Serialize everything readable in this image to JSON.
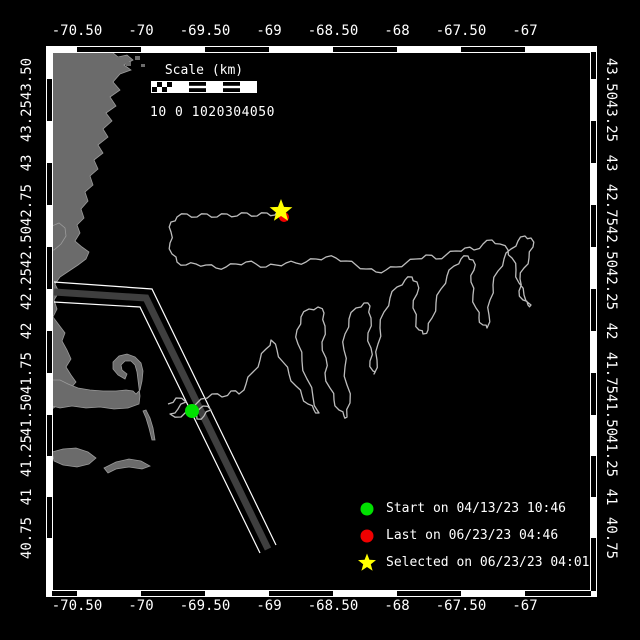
{
  "figure": {
    "background": "#000000",
    "text_color": "#ffffff",
    "frame_color": "#ffffff"
  },
  "axes": {
    "top": {
      "labels": [
        "-70.50",
        "-70",
        "-69.50",
        "-69",
        "-68.50",
        "-68",
        "-67.50",
        "-67"
      ],
      "positions_px": [
        77,
        141,
        205,
        269,
        333,
        397,
        461,
        525
      ],
      "center_y": 31
    },
    "bottom": {
      "labels": [
        "-70.50",
        "-70",
        "-69.50",
        "-69",
        "-68.50",
        "-68",
        "-67.50",
        "-67"
      ],
      "positions_px": [
        77,
        141,
        205,
        269,
        333,
        397,
        461,
        525
      ],
      "center_y": 606
    },
    "left": {
      "labels": [
        "43.50",
        "43.25",
        "43",
        "42.75",
        "42.50",
        "42.25",
        "42",
        "41.75",
        "41.50",
        "41.25",
        "41",
        "40.75"
      ],
      "positions_px": [
        79,
        121,
        163,
        205,
        247,
        289,
        331,
        373,
        415,
        456,
        497,
        538
      ],
      "center_x": 27
    },
    "right": {
      "labels": [
        "43.50",
        "43.25",
        "43",
        "42.75",
        "42.50",
        "42.25",
        "42",
        "41.75",
        "41.50",
        "41.25",
        "41",
        "40.75"
      ],
      "positions_px": [
        79,
        121,
        163,
        205,
        247,
        289,
        331,
        373,
        415,
        456,
        497,
        538
      ],
      "center_x": 611
    }
  },
  "scale_bar": {
    "title": "Scale (km)",
    "tick_text": "10 0 1020304050"
  },
  "legend": {
    "items": [
      {
        "marker": "circle",
        "color": "#00e100",
        "label": "Start on 04/13/23 10:46"
      },
      {
        "marker": "circle",
        "color": "#f00000",
        "label": "Last on 06/23/23 04:46"
      },
      {
        "marker": "star",
        "color": "#ffff00",
        "label": "Selected on 06/23/23 04:01"
      }
    ]
  },
  "map": {
    "colors": {
      "land": "#6b6b6b",
      "coast_stroke": "#9b9b9b",
      "water": "#000000",
      "track": "#bdbdbd",
      "lane": "#3f3f3f",
      "lane_edge": "#ffffff"
    },
    "markers": {
      "start": {
        "x": 192,
        "y": 411,
        "color": "#00e100",
        "r": 7
      },
      "last": {
        "x": 284,
        "y": 217,
        "color": "#f00000",
        "r": 5
      },
      "selected": {
        "x": 281,
        "y": 211,
        "color": "#ffff00",
        "size": 12
      }
    },
    "track": {
      "points": [
        [
          168,
          404
        ],
        [
          176,
          398
        ],
        [
          186,
          402
        ],
        [
          178,
          409
        ],
        [
          170,
          414
        ],
        [
          181,
          417
        ],
        [
          192,
          411
        ],
        [
          203,
          406
        ],
        [
          211,
          410
        ],
        [
          204,
          416
        ],
        [
          197,
          419
        ],
        [
          193,
          412
        ],
        [
          201,
          399
        ],
        [
          212,
          394
        ],
        [
          222,
          397
        ],
        [
          231,
          391
        ],
        [
          239,
          394
        ],
        [
          246,
          384
        ],
        [
          253,
          372
        ],
        [
          260,
          360
        ],
        [
          266,
          349
        ],
        [
          271,
          340
        ],
        [
          277,
          350
        ],
        [
          283,
          362
        ],
        [
          289,
          374
        ],
        [
          296,
          386
        ],
        [
          302,
          396
        ],
        [
          308,
          404
        ],
        [
          314,
          410
        ],
        [
          319,
          413
        ],
        [
          313,
          397
        ],
        [
          307,
          379
        ],
        [
          302,
          361
        ],
        [
          298,
          344
        ],
        [
          297,
          330
        ],
        [
          301,
          317
        ],
        [
          309,
          309
        ],
        [
          318,
          307
        ],
        [
          324,
          313
        ],
        [
          325,
          326
        ],
        [
          322,
          342
        ],
        [
          326,
          358
        ],
        [
          325,
          373
        ],
        [
          330,
          388
        ],
        [
          334,
          400
        ],
        [
          339,
          410
        ],
        [
          344,
          416
        ],
        [
          347,
          417
        ],
        [
          350,
          403
        ],
        [
          347,
          385
        ],
        [
          345,
          367
        ],
        [
          344,
          350
        ],
        [
          345,
          334
        ],
        [
          349,
          319
        ],
        [
          356,
          308
        ],
        [
          364,
          303
        ],
        [
          370,
          306
        ],
        [
          371,
          318
        ],
        [
          368,
          333
        ],
        [
          371,
          348
        ],
        [
          370,
          361
        ],
        [
          373,
          371
        ],
        [
          374,
          374
        ],
        [
          377,
          360
        ],
        [
          378,
          344
        ],
        [
          380,
          328
        ],
        [
          384,
          312
        ],
        [
          390,
          298
        ],
        [
          397,
          287
        ],
        [
          405,
          280
        ],
        [
          412,
          277
        ],
        [
          417,
          282
        ],
        [
          417,
          294
        ],
        [
          413,
          308
        ],
        [
          416,
          322
        ],
        [
          419,
          330
        ],
        [
          423,
          334
        ],
        [
          428,
          330
        ],
        [
          432,
          318
        ],
        [
          436,
          303
        ],
        [
          441,
          289
        ],
        [
          447,
          276
        ],
        [
          454,
          266
        ],
        [
          461,
          259
        ],
        [
          468,
          256
        ],
        [
          473,
          260
        ],
        [
          474,
          270
        ],
        [
          471,
          282
        ],
        [
          473,
          295
        ],
        [
          476,
          308
        ],
        [
          479,
          318
        ],
        [
          483,
          325
        ],
        [
          487,
          328
        ],
        [
          489,
          315
        ],
        [
          490,
          300
        ],
        [
          493,
          285
        ],
        [
          498,
          271
        ],
        [
          504,
          259
        ],
        [
          511,
          249
        ],
        [
          518,
          241
        ],
        [
          525,
          236
        ],
        [
          531,
          238
        ],
        [
          533,
          247
        ],
        [
          529,
          258
        ],
        [
          524,
          268
        ],
        [
          520,
          279
        ],
        [
          519,
          291
        ],
        [
          523,
          300
        ],
        [
          528,
          305
        ],
        [
          531,
          305
        ],
        [
          524,
          295
        ],
        [
          519,
          283
        ],
        [
          516,
          270
        ],
        [
          512,
          258
        ],
        [
          508,
          250
        ],
        [
          500,
          244
        ],
        [
          492,
          240
        ],
        [
          483,
          244
        ],
        [
          474,
          250
        ],
        [
          465,
          248
        ],
        [
          456,
          251
        ],
        [
          446,
          255
        ],
        [
          436,
          259
        ],
        [
          426,
          255
        ],
        [
          416,
          259
        ],
        [
          406,
          263
        ],
        [
          396,
          267
        ],
        [
          386,
          270
        ],
        [
          376,
          272
        ],
        [
          366,
          269
        ],
        [
          356,
          265
        ],
        [
          346,
          261
        ],
        [
          336,
          258
        ],
        [
          326,
          257
        ],
        [
          316,
          259
        ],
        [
          306,
          262
        ],
        [
          296,
          263
        ],
        [
          286,
          263
        ],
        [
          276,
          265
        ],
        [
          266,
          267
        ],
        [
          256,
          264
        ],
        [
          246,
          262
        ],
        [
          236,
          264
        ],
        [
          226,
          267
        ],
        [
          216,
          268
        ],
        [
          206,
          265
        ],
        [
          196,
          264
        ],
        [
          186,
          265
        ],
        [
          177,
          262
        ],
        [
          172,
          254
        ],
        [
          170,
          243
        ],
        [
          171,
          232
        ],
        [
          171,
          222
        ],
        [
          177,
          217
        ],
        [
          187,
          214
        ],
        [
          197,
          217
        ],
        [
          207,
          214
        ],
        [
          217,
          217
        ],
        [
          227,
          214
        ],
        [
          237,
          216
        ],
        [
          247,
          213
        ],
        [
          257,
          216
        ],
        [
          267,
          213
        ],
        [
          275,
          215
        ],
        [
          281,
          212
        ]
      ]
    },
    "shipping_lane": {
      "center": [
        [
          54,
          292
        ],
        [
          146,
          298
        ],
        [
          268,
          549
        ]
      ],
      "edge_upper": [
        [
          54,
          282
        ],
        [
          152,
          289
        ],
        [
          276,
          545
        ]
      ],
      "edge_lower": [
        [
          54,
          302
        ],
        [
          140,
          307
        ],
        [
          260,
          553
        ]
      ]
    },
    "land": {
      "mainland": [
        [
          52,
          52
        ],
        [
          112,
          52
        ],
        [
          118,
          57
        ],
        [
          127,
          55
        ],
        [
          133,
          60
        ],
        [
          124,
          65
        ],
        [
          131,
          70
        ],
        [
          120,
          74
        ],
        [
          113,
          82
        ],
        [
          120,
          90
        ],
        [
          110,
          97
        ],
        [
          116,
          106
        ],
        [
          106,
          113
        ],
        [
          112,
          121
        ],
        [
          103,
          129
        ],
        [
          108,
          137
        ],
        [
          98,
          145
        ],
        [
          103,
          153
        ],
        [
          94,
          160
        ],
        [
          98,
          169
        ],
        [
          90,
          176
        ],
        [
          93,
          185
        ],
        [
          85,
          192
        ],
        [
          88,
          201
        ],
        [
          81,
          209
        ],
        [
          84,
          218
        ],
        [
          77,
          225
        ],
        [
          80,
          233
        ],
        [
          75,
          241
        ],
        [
          82,
          247
        ],
        [
          89,
          252
        ],
        [
          86,
          259
        ],
        [
          78,
          265
        ],
        [
          69,
          271
        ],
        [
          60,
          277
        ],
        [
          55,
          284
        ],
        [
          59,
          292
        ],
        [
          54,
          300
        ],
        [
          57,
          309
        ],
        [
          53,
          317
        ],
        [
          59,
          325
        ],
        [
          65,
          333
        ],
        [
          62,
          341
        ],
        [
          67,
          350
        ],
        [
          71,
          359
        ],
        [
          66,
          367
        ],
        [
          71,
          375
        ],
        [
          76,
          382
        ],
        [
          70,
          389
        ],
        [
          64,
          395
        ],
        [
          60,
          402
        ],
        [
          55,
          407
        ],
        [
          52,
          409
        ]
      ],
      "cape_cod": [
        [
          52,
          380
        ],
        [
          60,
          380
        ],
        [
          68,
          384
        ],
        [
          78,
          388
        ],
        [
          90,
          390
        ],
        [
          103,
          391
        ],
        [
          116,
          391
        ],
        [
          126,
          390
        ],
        [
          133,
          391
        ],
        [
          136,
          394
        ],
        [
          140,
          390
        ],
        [
          142,
          381
        ],
        [
          143,
          371
        ],
        [
          141,
          363
        ],
        [
          135,
          357
        ],
        [
          127,
          354
        ],
        [
          119,
          356
        ],
        [
          113,
          362
        ],
        [
          113,
          369
        ],
        [
          118,
          375
        ],
        [
          125,
          379
        ],
        [
          127,
          374
        ],
        [
          122,
          370
        ],
        [
          121,
          365
        ],
        [
          125,
          361
        ],
        [
          131,
          361
        ],
        [
          135,
          365
        ],
        [
          137,
          372
        ],
        [
          138,
          380
        ],
        [
          139,
          388
        ],
        [
          140,
          396
        ],
        [
          139,
          404
        ],
        [
          128,
          408
        ],
        [
          114,
          409
        ],
        [
          100,
          407
        ],
        [
          86,
          408
        ],
        [
          72,
          406
        ],
        [
          60,
          408
        ],
        [
          52,
          406
        ]
      ],
      "cape_ann": [
        [
          52,
          226
        ],
        [
          59,
          223
        ],
        [
          65,
          228
        ],
        [
          66,
          236
        ],
        [
          61,
          244
        ],
        [
          54,
          250
        ],
        [
          52,
          250
        ]
      ],
      "marthas_vineyard": [
        [
          52,
          452
        ],
        [
          63,
          449
        ],
        [
          76,
          448
        ],
        [
          88,
          452
        ],
        [
          96,
          458
        ],
        [
          89,
          464
        ],
        [
          77,
          467
        ],
        [
          63,
          465
        ],
        [
          54,
          461
        ]
      ],
      "nantucket": [
        [
          104,
          468
        ],
        [
          116,
          462
        ],
        [
          129,
          459
        ],
        [
          141,
          461
        ],
        [
          150,
          466
        ],
        [
          142,
          469
        ],
        [
          129,
          467
        ],
        [
          116,
          469
        ],
        [
          108,
          473
        ]
      ],
      "monomoy": [
        [
          146,
          410
        ],
        [
          150,
          418
        ],
        [
          153,
          428
        ],
        [
          155,
          440
        ],
        [
          152,
          440
        ],
        [
          149,
          428
        ],
        [
          146,
          418
        ],
        [
          143,
          411
        ]
      ],
      "islets": [
        [
          116,
          57,
          6,
          4
        ],
        [
          126,
          62,
          5,
          4
        ],
        [
          135,
          56,
          5,
          4
        ],
        [
          141,
          64,
          4,
          3
        ],
        [
          108,
          66,
          4,
          3
        ]
      ]
    },
    "frame": {
      "outer": [
        46.5,
        46.5,
        550,
        550
      ],
      "inner": [
        52.5,
        52.5,
        538,
        538
      ],
      "top_black_segments": [
        [
          77,
          141
        ],
        [
          205,
          269
        ],
        [
          333,
          397
        ],
        [
          461,
          525
        ]
      ],
      "bottom_black_segments": [
        [
          52,
          77
        ],
        [
          141,
          205
        ],
        [
          269,
          333
        ],
        [
          397,
          461
        ],
        [
          525,
          591
        ]
      ],
      "left_black_segments": [
        [
          79,
          121
        ],
        [
          163,
          205
        ],
        [
          247,
          289
        ],
        [
          331,
          373
        ],
        [
          415,
          456
        ],
        [
          497,
          538
        ]
      ],
      "right_black_segments": [
        [
          52,
          79
        ],
        [
          121,
          163
        ],
        [
          205,
          247
        ],
        [
          289,
          331
        ],
        [
          373,
          415
        ],
        [
          456,
          497
        ],
        [
          538,
          591
        ]
      ]
    }
  }
}
